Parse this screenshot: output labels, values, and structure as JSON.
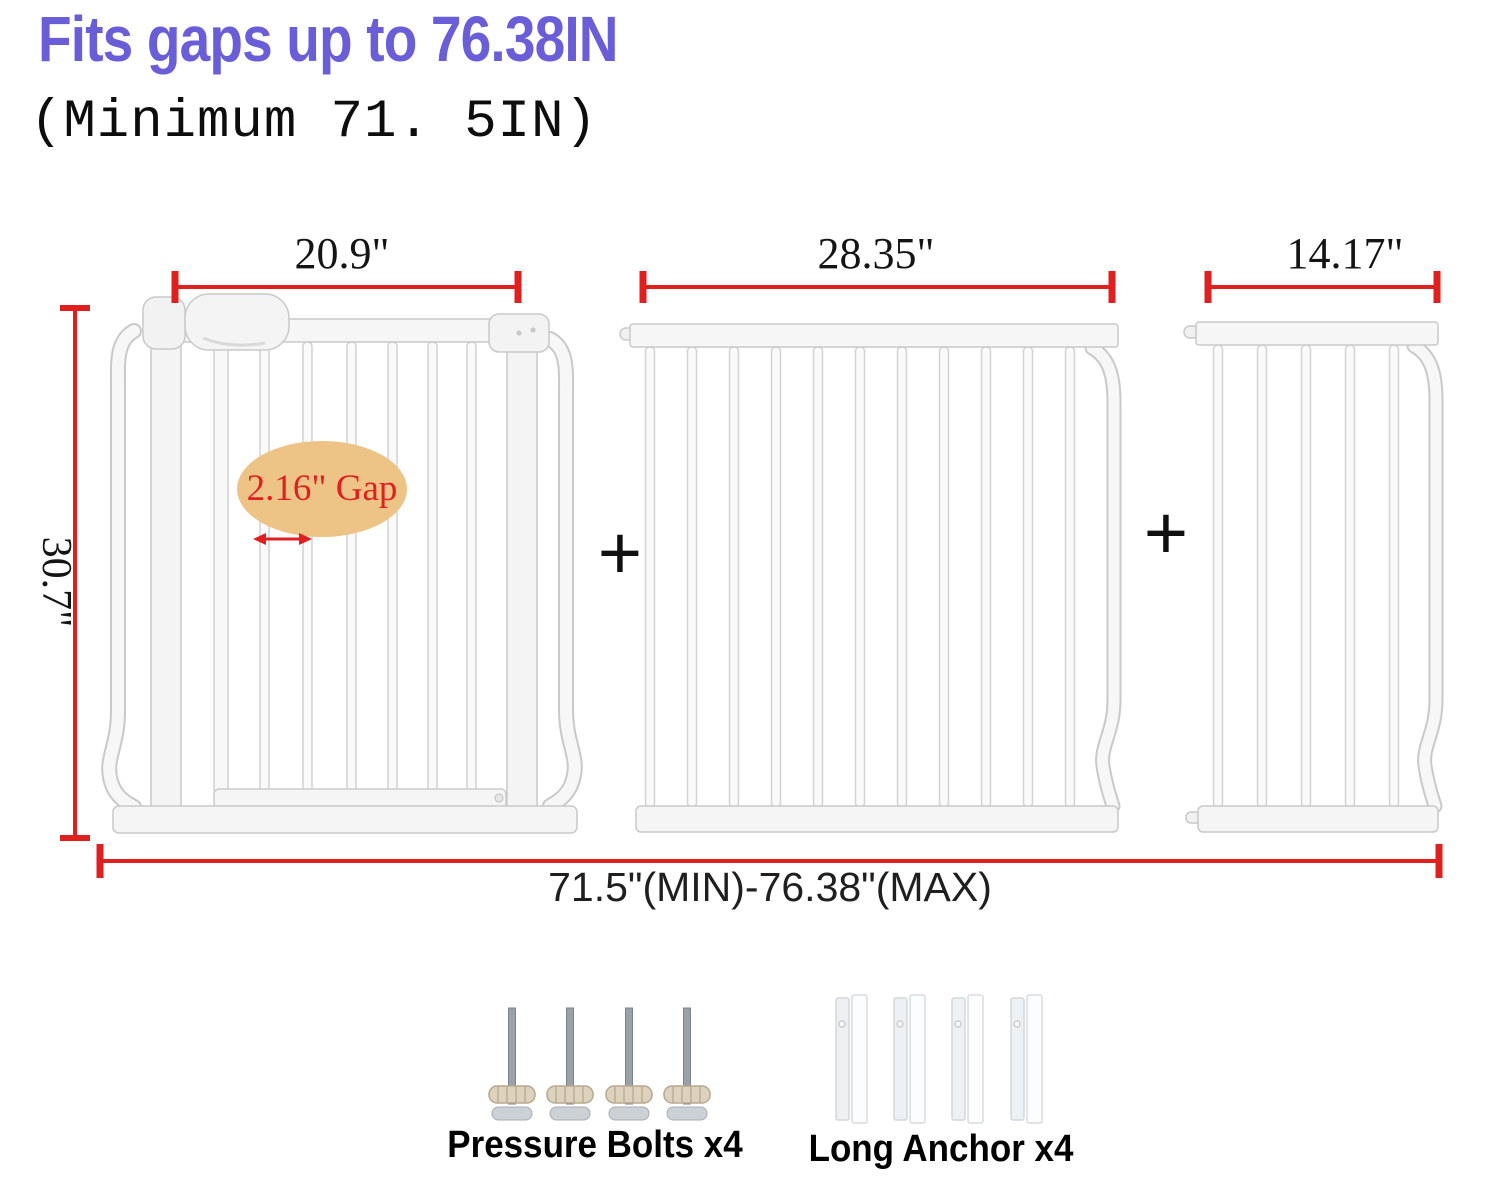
{
  "header": {
    "title": "Fits gaps up to 76.38IN",
    "subtitle": "(Minimum 71. 5IN)"
  },
  "dimensions": {
    "door_panel_width": "20.9\"",
    "extension_large_width": "28.35\"",
    "extension_small_width": "14.17\"",
    "gate_height": "30.7\"",
    "total_range": "71.5\"(MIN)-76.38\"(MAX)",
    "bar_gap": "2.16\" Gap"
  },
  "plus_sign": "+",
  "hardware": {
    "pressure_bolts_label": "Pressure Bolts x4",
    "long_anchor_label": "Long Anchor x4"
  },
  "colors": {
    "title_purple": "#6a5ed8",
    "dimension_red": "#e01f1f",
    "gap_ellipse_fill": "#edc485",
    "gap_text_red": "#e02020",
    "gate_white": "#f7f7f7",
    "text_black": "#111111"
  }
}
